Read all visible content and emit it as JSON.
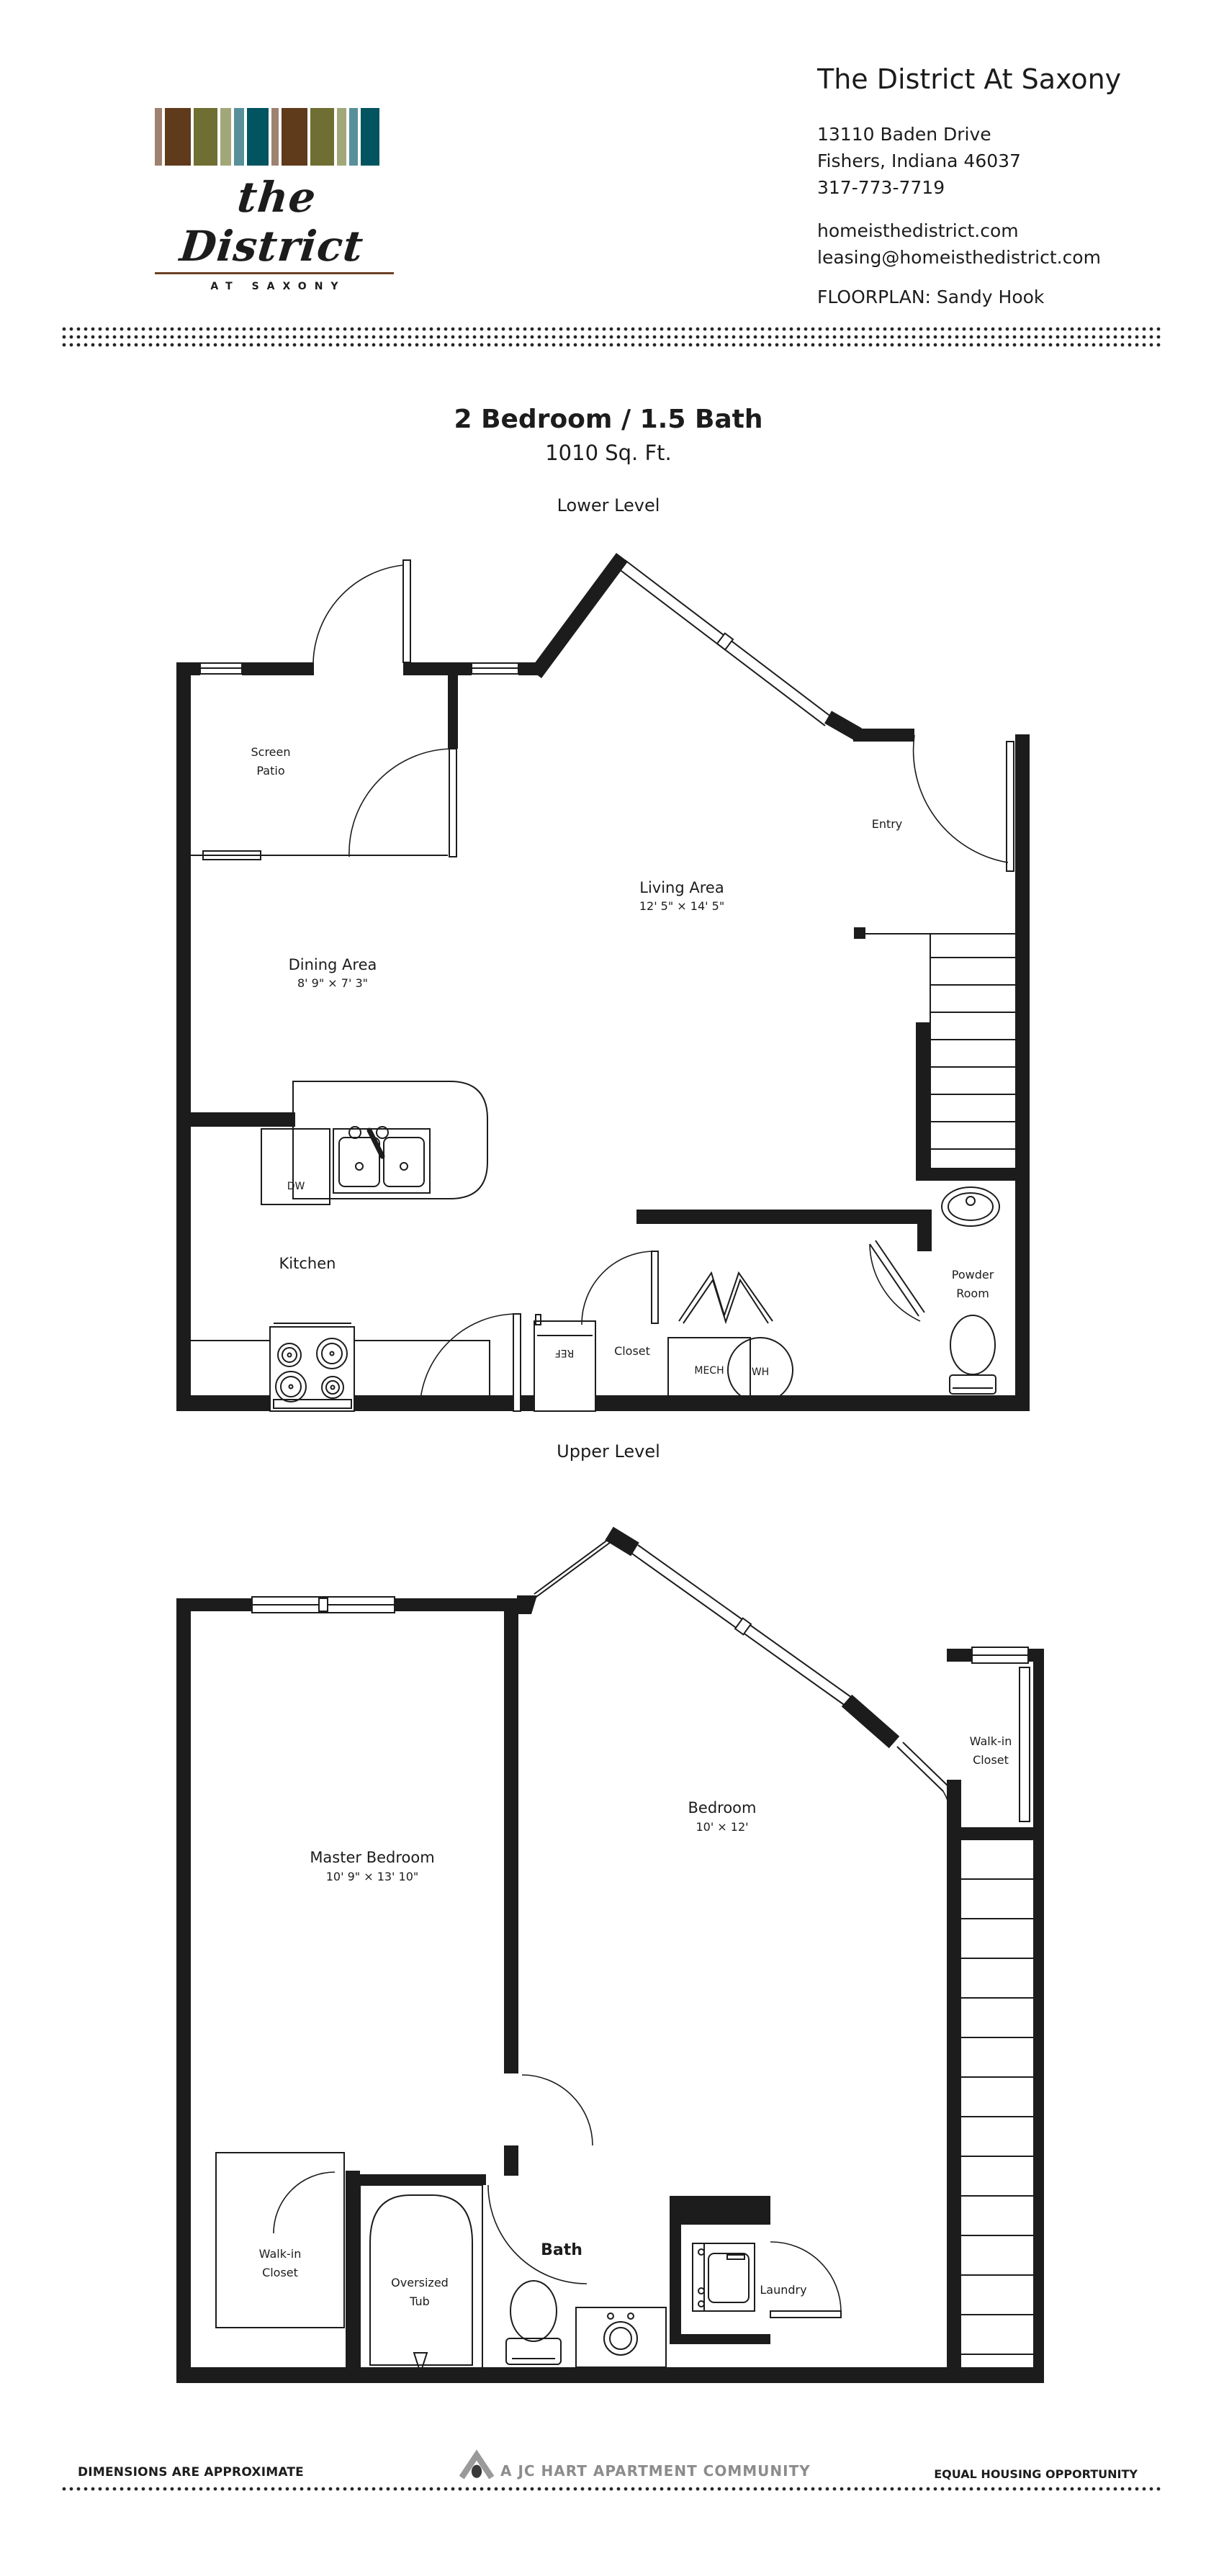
{
  "header": {
    "property_name": "The District At Saxony",
    "address_line1": "13110 Baden Drive",
    "address_line2": "Fishers, Indiana 46037",
    "phone": "317-773-7719",
    "website": "homeisthedistrict.com",
    "email": "leasing@homeisthedistrict.com",
    "floorplan_label": "FLOORPLAN: Sandy Hook",
    "logo": {
      "script_text": "the District",
      "sub_text": "AT SAXONY",
      "rule_color": "#6b4124",
      "stripes": [
        {
          "c": "#9f8170",
          "w": 10
        },
        {
          "c": "#5f3a1b",
          "w": 36
        },
        {
          "c": "#6f6e33",
          "w": 33
        },
        {
          "c": "#a2a77a",
          "w": 15
        },
        {
          "c": "#58909a",
          "w": 14
        },
        {
          "c": "#015460",
          "w": 30
        },
        {
          "c": "#9f8170",
          "w": 10
        },
        {
          "c": "#5f3a1b",
          "w": 36
        },
        {
          "c": "#6f6e33",
          "w": 33
        },
        {
          "c": "#a2a77a",
          "w": 13
        },
        {
          "c": "#58909a",
          "w": 12
        },
        {
          "c": "#015460",
          "w": 26
        }
      ]
    }
  },
  "plan": {
    "title": "2 Bedroom / 1.5 Bath",
    "sqft": "1010 Sq. Ft.",
    "lower_label": "Lower Level",
    "upper_label": "Upper Level",
    "lower": {
      "screen_patio_1": "Screen",
      "screen_patio_2": "Patio",
      "entry": "Entry",
      "living": {
        "name": "Living Area",
        "dims": "12' 5\" × 14' 5\""
      },
      "dining": {
        "name": "Dining Area",
        "dims": "8' 9\" × 7' 3\""
      },
      "kitchen": "Kitchen",
      "dw": "DW",
      "ref": "REF",
      "closet": "Closet",
      "mech": "MECH",
      "wh": "WH",
      "powder_1": "Powder",
      "powder_2": "Room"
    },
    "upper": {
      "master": {
        "name": "Master Bedroom",
        "dims": "10' 9\" × 13' 10\""
      },
      "bedroom": {
        "name": "Bedroom",
        "dims": "10' × 12'"
      },
      "walkin_upper_1": "Walk-in",
      "walkin_upper_2": "Closet",
      "walkin_lower_1": "Walk-in",
      "walkin_lower_2": "Closet",
      "bath": "Bath",
      "tub_1": "Oversized",
      "tub_2": "Tub",
      "laundry": "Laundry"
    }
  },
  "footer": {
    "dimensions_note": "DIMENSIONS ARE APPROXIMATE",
    "community": "A JC HART APARTMENT COMMUNITY",
    "equal_housing": "EQUAL HOUSING OPPORTUNITY"
  }
}
